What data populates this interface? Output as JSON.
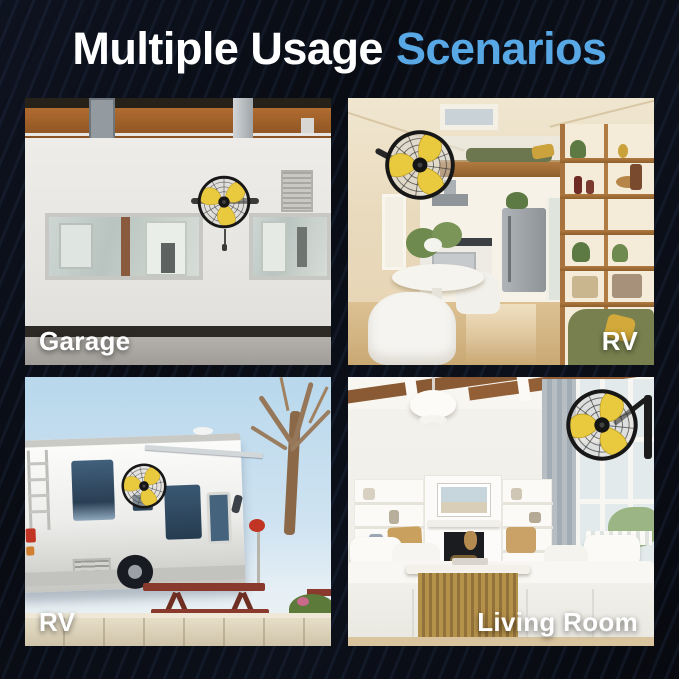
{
  "title": {
    "white_part": "Multiple Usage",
    "accent_part": "Scenarios"
  },
  "colors": {
    "accent_blue": "#58a8e6",
    "background_navy": "#0a0d14",
    "label_white": "#ffffff",
    "fan_blade_yellow": "#e9c93d",
    "fan_cage_black": "#171717"
  },
  "scenarios": [
    {
      "id": "garage",
      "label": "Garage",
      "label_position": "bottom-left"
    },
    {
      "id": "rv-interior",
      "label": "RV",
      "label_position": "bottom-right"
    },
    {
      "id": "rv-exterior",
      "label": "RV",
      "label_position": "bottom-left"
    },
    {
      "id": "living-room",
      "label": "Living Room",
      "label_position": "bottom-right"
    }
  ]
}
